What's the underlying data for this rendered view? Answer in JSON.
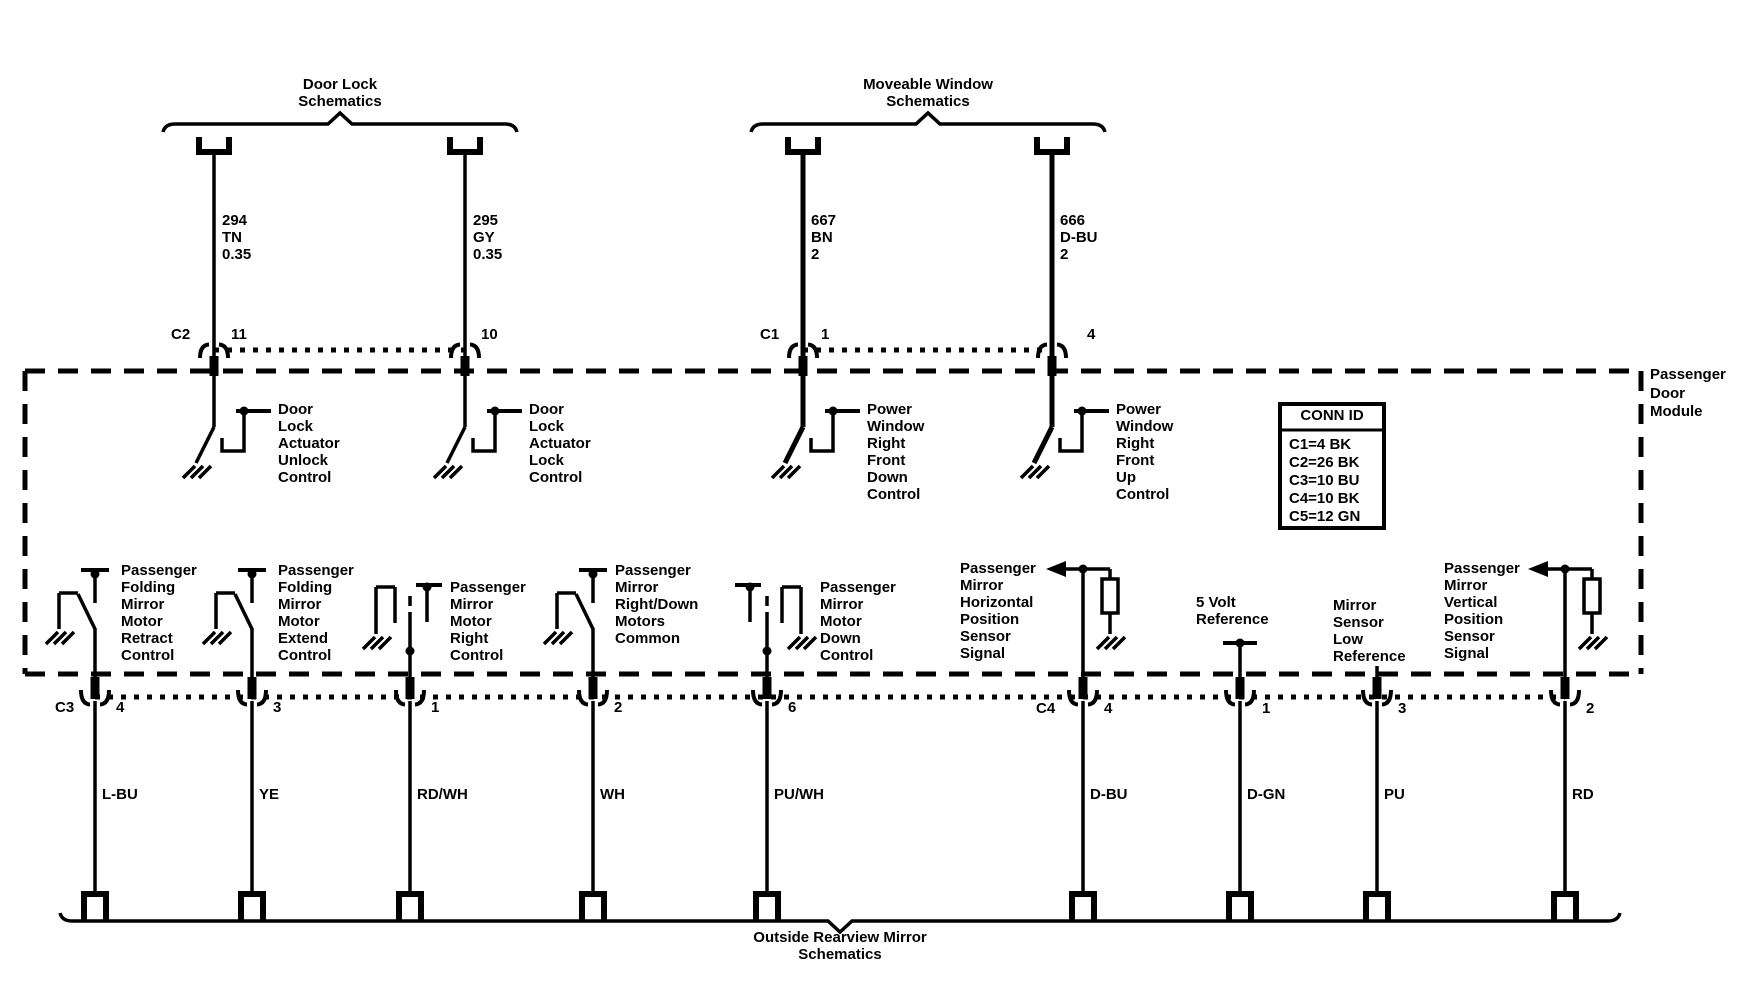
{
  "diagram": {
    "braces": {
      "door_lock": "Door Lock\nSchematics",
      "moveable_window": "Moveable Window\nSchematics",
      "outside_mirror": "Outside Rearview Mirror\nSchematics"
    },
    "module_name": "Passenger\nDoor\nModule",
    "conn_id": {
      "title": "CONN ID",
      "rows": [
        "C1=4 BK",
        "C2=26 BK",
        "C3=10 BU",
        "C4=10 BK",
        "C5=12 GN"
      ]
    },
    "connector_labels": {
      "c1": "C1",
      "c2": "C2",
      "c3": "C3",
      "c4": "C4"
    },
    "top_circuits": [
      {
        "wire": "294\nTN\n0.35",
        "pin": "11",
        "function": "Door\nLock\nActuator\nUnlock\nControl"
      },
      {
        "wire": "295\nGY\n0.35",
        "pin": "10",
        "function": "Door\nLock\nActuator\nLock\nControl"
      },
      {
        "wire": "667\nBN\n2",
        "pin": "1",
        "function": "Power\nWindow\nRight\nFront\nDown\nControl"
      },
      {
        "wire": "666\nD-BU\n2",
        "pin": "4",
        "function": "Power\nWindow\nRight\nFront\nUp\nControl"
      }
    ],
    "bottom_circuits": [
      {
        "pin": "4",
        "color": "L-BU",
        "function": "Passenger\nFolding\nMirror\nMotor\nRetract\nControl"
      },
      {
        "pin": "3",
        "color": "YE",
        "function": "Passenger\nFolding\nMirror\nMotor\nExtend\nControl"
      },
      {
        "pin": "1",
        "color": "RD/WH",
        "function": "Passenger\nMirror\nMotor\nRight\nControl"
      },
      {
        "pin": "2",
        "color": "WH",
        "function": "Passenger\nMirror\nRight/Down\nMotors\nCommon"
      },
      {
        "pin": "6",
        "color": "PU/WH",
        "function": "Passenger\nMirror\nMotor\nDown\nControl"
      },
      {
        "pin": "4",
        "color": "D-BU",
        "function": "Passenger\nMirror\nHorizontal\nPosition\nSensor\nSignal"
      },
      {
        "pin": "1",
        "color": "D-GN",
        "function": "5 Volt\nReference"
      },
      {
        "pin": "3",
        "color": "PU",
        "function": "Mirror\nSensor\nLow\nReference"
      },
      {
        "pin": "2",
        "color": "RD",
        "function": "Passenger\nMirror\nVertical\nPosition\nSensor\nSignal"
      }
    ]
  }
}
